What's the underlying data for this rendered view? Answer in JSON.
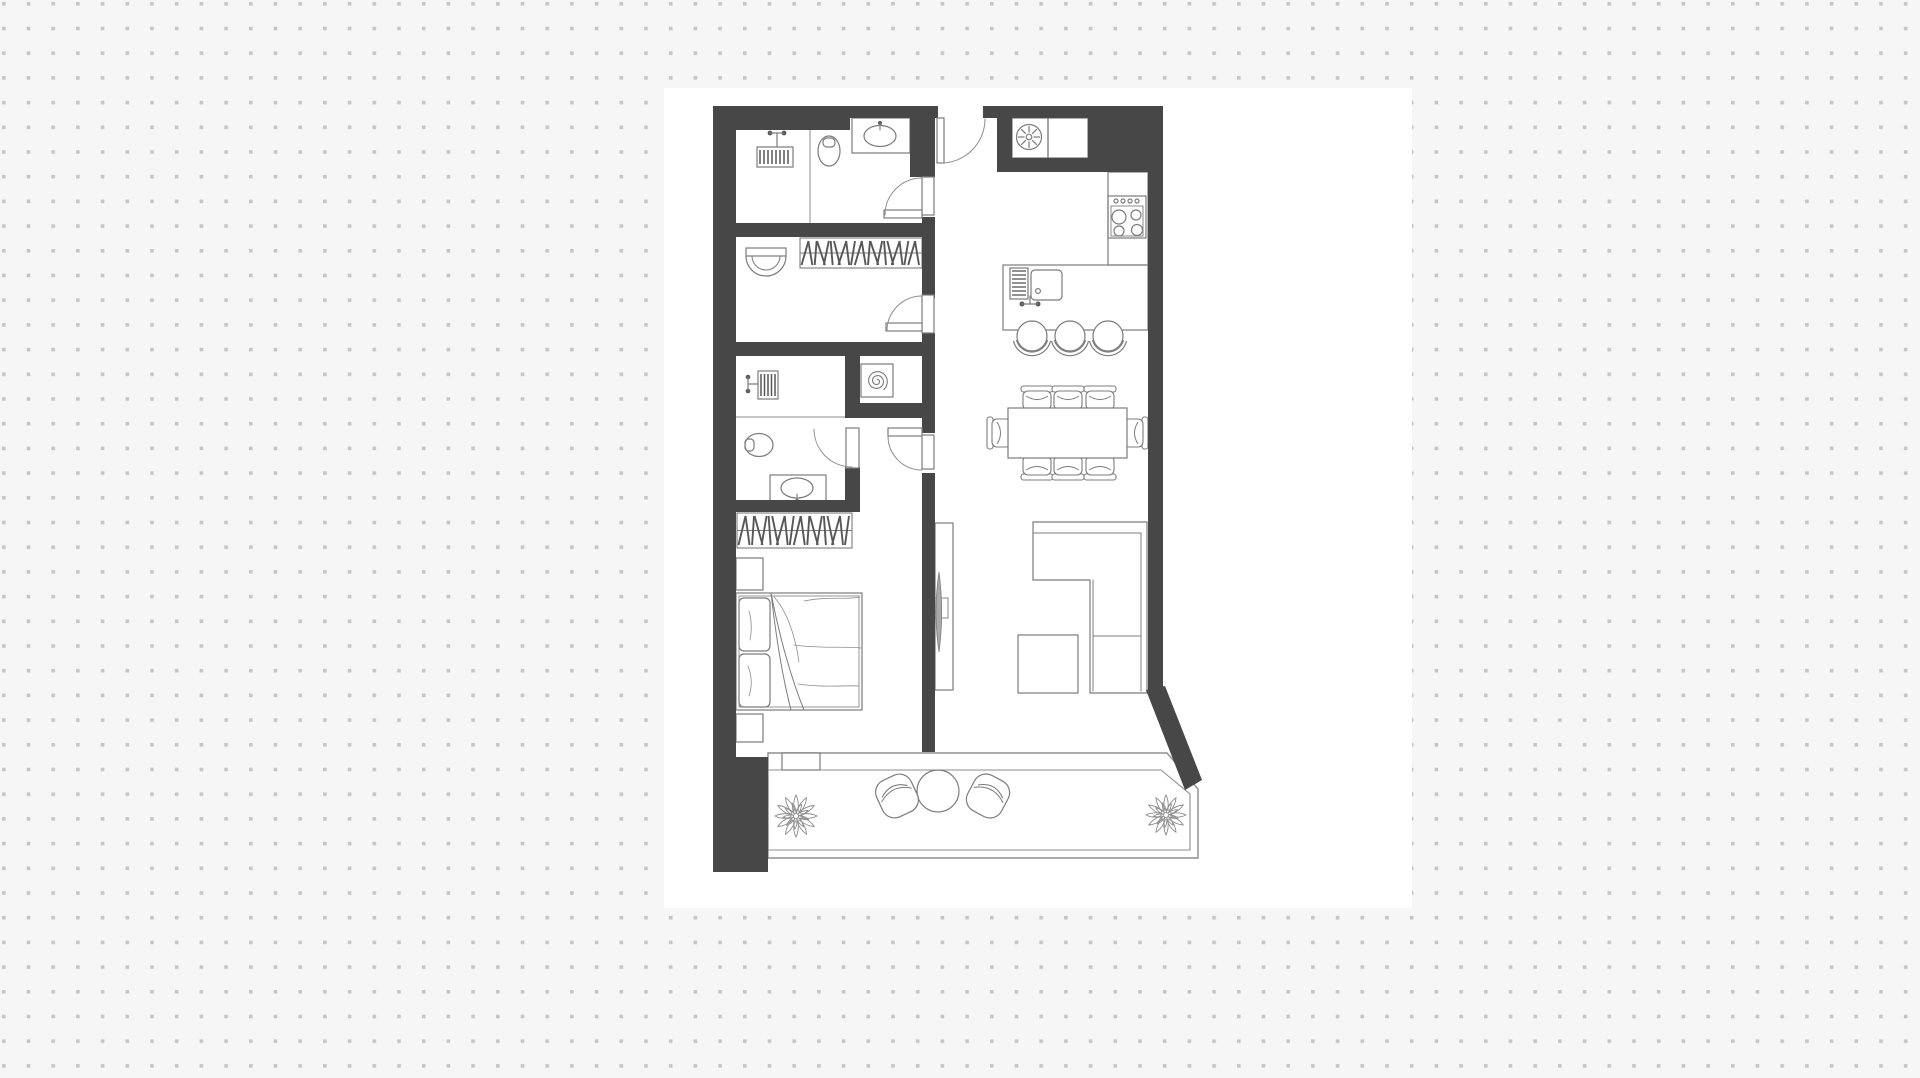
{
  "canvas": {
    "width": 1920,
    "height": 1078,
    "dot_spacing": 24.7,
    "dot_size": 3.6,
    "card": {
      "x": 664,
      "y": 88,
      "w": 748,
      "h": 820
    }
  },
  "palette": {
    "background": "#f6f6f6",
    "dot": "#c6c6c6",
    "card": "#ffffff",
    "wall": "#474747",
    "furniture_line": "#7c7c7c",
    "thin_line": "#8d8d8d",
    "hatch": "#575757",
    "tv_screen": "#a9a9a9"
  },
  "floor_plan": {
    "description": "apartment-floor-plan-top-view",
    "elements": [
      {
        "t": "sil",
        "n": "apartment-outline",
        "pts": [
          [
            713,
            106
          ],
          [
            1163,
            106
          ],
          [
            1163,
            688
          ],
          [
            1200,
            782
          ],
          [
            1200,
            858
          ],
          [
            713,
            858
          ]
        ]
      },
      {
        "t": "path",
        "n": "balcony-outer-border",
        "d": "M768,753 L1167,753 L1198,789 L1198,858 L768,858 Z",
        "s": "thin",
        "w": 1.4
      },
      {
        "t": "path",
        "n": "balcony-inner-border",
        "d": "M768,770 L1161,770 L1190,794 L1190,850 L768,850",
        "s": "thin",
        "w": 1.1
      },
      {
        "t": "line",
        "n": "bathroom1-divider",
        "l": [
          810,
          130,
          810,
          223
        ]
      },
      {
        "t": "orect",
        "n": "washing-machine",
        "r": [
          757,
          147,
          36,
          20
        ]
      },
      {
        "t": "hatchv",
        "n": "washing-machine-hatch",
        "r": [
          760,
          150,
          30,
          14
        ],
        "gap": 4
      },
      {
        "t": "dot",
        "n": "faucet-valve",
        "c": [
          770,
          133,
          2.4
        ]
      },
      {
        "t": "dot",
        "n": "faucet-valve",
        "c": [
          784,
          133,
          2.4
        ]
      },
      {
        "t": "path",
        "n": "washer-faucet",
        "d": "M770,133 L784,133 M777,133 L777,147",
        "w": 1.2
      },
      {
        "t": "ell",
        "n": "toilet-bowl",
        "e": [
          829,
          151,
          11,
          15
        ]
      },
      {
        "t": "orect",
        "n": "toilet-flush",
        "r": [
          823,
          138,
          12,
          9
        ],
        "rx": 4
      },
      {
        "t": "wrect",
        "n": "sink-counter",
        "r": [
          852,
          118,
          58,
          35
        ]
      },
      {
        "t": "ell",
        "n": "sink-basin",
        "e": [
          880,
          136,
          16,
          10.5
        ]
      },
      {
        "t": "dot",
        "n": "sink-faucet",
        "c": [
          880,
          123,
          2
        ]
      },
      {
        "t": "path",
        "n": "sink-faucet-stem",
        "d": "M880,123 L880,130",
        "w": 1.1
      },
      {
        "t": "rail",
        "n": "closet-hanger-rail",
        "r": [
          800,
          238,
          122,
          30
        ],
        "nl": 22
      },
      {
        "t": "wrect",
        "n": "wall-basin-top",
        "r": [
          746,
          248,
          40,
          8
        ]
      },
      {
        "t": "path",
        "n": "wall-basin",
        "d": "M746,256 A20,20 0 0 0 786,256",
        "w": 1.2
      },
      {
        "t": "path",
        "n": "wall-basin-inner",
        "d": "M752,256 A14,14 0 0 0 780,256",
        "w": 1
      },
      {
        "t": "orect",
        "n": "boiler-box",
        "r": [
          861,
          364,
          32,
          33
        ]
      },
      {
        "t": "spiral",
        "n": "boiler-spiral",
        "c": [
          877,
          381
        ],
        "r0": 1.5,
        "r1": 11,
        "turns": 2.4
      },
      {
        "t": "orect",
        "n": "washing-machine-2",
        "r": [
          758,
          371,
          20,
          28
        ]
      },
      {
        "t": "hatchv",
        "n": "washing-machine-2-hatch",
        "r": [
          761,
          374,
          14,
          22
        ],
        "gap": 3.5
      },
      {
        "t": "dot",
        "n": "faucet-valve",
        "c": [
          748,
          377,
          2.3
        ]
      },
      {
        "t": "dot",
        "n": "faucet-valve",
        "c": [
          748,
          391,
          2.3
        ]
      },
      {
        "t": "path",
        "n": "washer2-faucet",
        "d": "M748,377 L748,391 M748,384 L758,384",
        "w": 1.2
      },
      {
        "t": "line",
        "n": "bathroom2-divider",
        "l": [
          736,
          417,
          845,
          417
        ]
      },
      {
        "t": "ell",
        "n": "toilet2-bowl",
        "e": [
          759,
          445,
          14,
          11.5
        ]
      },
      {
        "t": "orect",
        "n": "toilet2-flush",
        "r": [
          745,
          439,
          9,
          12
        ],
        "rx": 3.5
      },
      {
        "t": "wrect",
        "n": "sink2-counter",
        "r": [
          770,
          475,
          56,
          28
        ]
      },
      {
        "t": "ell",
        "n": "sink2-basin",
        "e": [
          797,
          488,
          16,
          10
        ]
      },
      {
        "t": "dot",
        "n": "sink2-faucet",
        "c": [
          797,
          501,
          2
        ]
      },
      {
        "t": "path",
        "n": "sink2-faucet-stem",
        "d": "M797,501 L797,494",
        "w": 1.1
      },
      {
        "t": "rail",
        "n": "wardrobe-hanger-rail",
        "r": [
          737,
          513,
          115,
          35
        ],
        "nl": 20
      },
      {
        "t": "orect",
        "n": "nightstand",
        "r": [
          736,
          558,
          27,
          32
        ]
      },
      {
        "t": "orect",
        "n": "nightstand",
        "r": [
          736,
          714,
          27,
          28
        ]
      },
      {
        "t": "orect",
        "n": "bed-frame",
        "r": [
          736,
          593,
          126,
          117
        ]
      },
      {
        "t": "orect",
        "n": "bed-mattress",
        "r": [
          739,
          596,
          120,
          111
        ],
        "w": 0.8
      },
      {
        "t": "wrect",
        "n": "pillow",
        "r": [
          739,
          598,
          31,
          53
        ],
        "rx": 5
      },
      {
        "t": "wrect",
        "n": "pillow",
        "r": [
          739,
          654,
          31,
          53
        ],
        "rx": 5
      },
      {
        "t": "path",
        "n": "pillow-crease",
        "d": "M749,611 Q753,625 750,640 M748,666 Q754,681 749,696",
        "w": 0.8,
        "s": "thin"
      },
      {
        "t": "path",
        "n": "blanket-fold",
        "d": "M771,593 C779,635 791,678 804,710 M771,593 C776,637 783,679 791,710",
        "w": 1
      },
      {
        "t": "path",
        "n": "blanket-sketch",
        "d": "M804,601 C828,596 848,600 860,597 M794,645 C822,649 846,646 861,648 M798,684 C824,688 847,685 859,686 M774,597 C788,612 796,640 799,662",
        "w": 0.8,
        "s": "thin"
      },
      {
        "t": "orect",
        "n": "entry-cabinet",
        "r": [
          1012,
          118,
          36,
          40
        ]
      },
      {
        "t": "orect",
        "n": "entry-cabinet",
        "r": [
          1048,
          118,
          40,
          40
        ]
      },
      {
        "t": "circ",
        "n": "extractor-fan",
        "c": [
          1029,
          137,
          12.5
        ]
      },
      {
        "t": "circ",
        "n": "extractor-fan-hub",
        "c": [
          1029,
          137,
          2.8
        ]
      },
      {
        "t": "spokes",
        "n": "extractor-fan-spokes",
        "c": [
          1029,
          137
        ],
        "r0": 4.5,
        "r1": 11,
        "nl": 8
      },
      {
        "t": "orect",
        "n": "kitchen-counter",
        "r": [
          1108,
          172,
          40,
          93
        ]
      },
      {
        "t": "orect",
        "n": "stove",
        "r": [
          1108,
          196,
          38,
          42
        ]
      },
      {
        "t": "orect",
        "n": "stove-panel",
        "r": [
          1111,
          206,
          32,
          30
        ],
        "w": 0.9
      },
      {
        "t": "circ",
        "n": "stove-knob",
        "c": [
          1116,
          201,
          2
        ]
      },
      {
        "t": "circ",
        "n": "stove-knob",
        "c": [
          1123,
          201,
          2
        ]
      },
      {
        "t": "circ",
        "n": "stove-knob",
        "c": [
          1130,
          201,
          2
        ]
      },
      {
        "t": "circ",
        "n": "stove-knob",
        "c": [
          1137,
          201,
          2
        ]
      },
      {
        "t": "circ",
        "n": "burner",
        "c": [
          1119,
          217,
          7
        ]
      },
      {
        "t": "circ",
        "n": "burner",
        "c": [
          1136,
          215,
          5
        ]
      },
      {
        "t": "circ",
        "n": "burner",
        "c": [
          1119,
          231,
          5
        ]
      },
      {
        "t": "circ",
        "n": "burner",
        "c": [
          1137,
          230,
          5.5
        ]
      },
      {
        "t": "orect",
        "n": "kitchen-island",
        "r": [
          1003,
          265,
          145,
          65
        ]
      },
      {
        "t": "orect",
        "n": "dish-rack",
        "r": [
          1010,
          268,
          18,
          31
        ]
      },
      {
        "t": "hatchh",
        "n": "dish-rack-bars",
        "r": [
          1012,
          271,
          14,
          26
        ],
        "gap": 4
      },
      {
        "t": "orect",
        "n": "island-sink",
        "r": [
          1031,
          270,
          31,
          30
        ],
        "rx": 4
      },
      {
        "t": "circ",
        "n": "sink-drain",
        "c": [
          1038,
          291,
          2.4
        ]
      },
      {
        "t": "dot",
        "n": "island-faucet-valve",
        "c": [
          1022,
          304,
          2.5
        ]
      },
      {
        "t": "dot",
        "n": "island-faucet-valve",
        "c": [
          1038,
          304,
          2.5
        ]
      },
      {
        "t": "path",
        "n": "island-faucet",
        "d": "M1022,304 L1038,304 M1030,304 L1030,296",
        "w": 1.2
      },
      {
        "t": "stool",
        "n": "bar-stool",
        "c": [
          1032,
          336
        ]
      },
      {
        "t": "stool",
        "n": "bar-stool",
        "c": [
          1070,
          336
        ]
      },
      {
        "t": "stool",
        "n": "bar-stool",
        "c": [
          1108,
          336
        ]
      },
      {
        "t": "chair",
        "n": "dining-chair",
        "c": [
          1037,
          398
        ],
        "rot": 0
      },
      {
        "t": "chair",
        "n": "dining-chair",
        "c": [
          1068,
          398
        ],
        "rot": 0
      },
      {
        "t": "chair",
        "n": "dining-chair",
        "c": [
          1100,
          398
        ],
        "rot": 0
      },
      {
        "t": "chair",
        "n": "dining-chair",
        "c": [
          1037,
          468
        ],
        "rot": 180
      },
      {
        "t": "chair",
        "n": "dining-chair",
        "c": [
          1068,
          468
        ],
        "rot": 180
      },
      {
        "t": "chair",
        "n": "dining-chair",
        "c": [
          1100,
          468
        ],
        "rot": 180
      },
      {
        "t": "chair",
        "n": "dining-chair",
        "c": [
          999,
          433
        ],
        "rot": 270
      },
      {
        "t": "chair",
        "n": "dining-chair",
        "c": [
          1136,
          433
        ],
        "rot": 90
      },
      {
        "t": "wrect",
        "n": "dining-table",
        "r": [
          1008,
          408,
          119,
          50
        ]
      },
      {
        "t": "path",
        "n": "sofa-outline",
        "d": "M1033,522 L1147,522 L1147,693 L1090,693 L1090,580 L1033,580 Z",
        "w": 1.2
      },
      {
        "t": "path",
        "n": "sofa-lines",
        "d": "M1033,533 L1141,533 M1141,533 L1141,691 M1093,580 L1093,691 M1093,636 L1141,636",
        "w": 1
      },
      {
        "t": "orect",
        "n": "coffee-table",
        "r": [
          1018,
          635,
          60,
          58
        ]
      },
      {
        "t": "orect",
        "n": "tv-panel",
        "r": [
          935,
          523,
          18,
          167
        ]
      },
      {
        "t": "orect",
        "n": "tv-mount",
        "r": [
          933,
          598,
          15,
          20
        ],
        "w": 0.9
      },
      {
        "t": "path",
        "n": "tv-screen",
        "d": "M939,572 C935,599 935,626 939,652 C942.5,626 942.5,599 939,572 Z",
        "f": "tv",
        "w": 0.8
      },
      {
        "t": "wrect",
        "n": "balcony-door",
        "r": [
          782,
          753,
          38,
          17
        ]
      },
      {
        "t": "circ",
        "n": "balcony-table",
        "c": [
          938,
          791,
          21
        ]
      },
      {
        "t": "bchair",
        "n": "balcony-chair",
        "c": [
          897,
          796
        ],
        "rot": -25
      },
      {
        "t": "bchair",
        "n": "balcony-chair",
        "c": [
          988,
          796
        ],
        "rot": 28
      },
      {
        "t": "plant",
        "n": "potted-plant",
        "c": [
          796,
          816
        ],
        "r": 21
      },
      {
        "t": "plant",
        "n": "potted-plant",
        "c": [
          1166,
          815
        ],
        "r": 20
      },
      {
        "t": "wallr",
        "n": "wall",
        "r": [
          713,
          106,
          137,
          24
        ]
      },
      {
        "t": "wallr",
        "n": "wall",
        "r": [
          850,
          106,
          88,
          12
        ]
      },
      {
        "t": "wallr",
        "n": "wall",
        "r": [
          983,
          106,
          29,
          12
        ]
      },
      {
        "t": "wallr",
        "n": "wall",
        "r": [
          997,
          118,
          15,
          54
        ]
      },
      {
        "t": "wallr",
        "n": "wall",
        "r": [
          1012,
          106,
          76,
          12
        ]
      },
      {
        "t": "wallr",
        "n": "wall",
        "r": [
          1012,
          158,
          76,
          14
        ]
      },
      {
        "t": "wallr",
        "n": "wall",
        "r": [
          1088,
          106,
          75,
          66
        ]
      },
      {
        "t": "wallr",
        "n": "wall",
        "r": [
          1148,
          172,
          15,
          520
        ]
      },
      {
        "t": "wallr",
        "n": "wall",
        "r": [
          713,
          106,
          23,
          651
        ]
      },
      {
        "t": "wallr",
        "n": "wall",
        "r": [
          713,
          757,
          55,
          115
        ]
      },
      {
        "t": "wallr",
        "n": "wall",
        "r": [
          713,
          223,
          222,
          14
        ]
      },
      {
        "t": "wallr",
        "n": "wall",
        "r": [
          713,
          342,
          222,
          14
        ]
      },
      {
        "t": "wallr",
        "n": "wall",
        "r": [
          845,
          356,
          15,
          62
        ]
      },
      {
        "t": "wallr",
        "n": "wall",
        "r": [
          860,
          403,
          75,
          15
        ]
      },
      {
        "t": "wallr",
        "n": "wall",
        "r": [
          845,
          467,
          15,
          45
        ]
      },
      {
        "t": "wallr",
        "n": "wall",
        "r": [
          713,
          500,
          132,
          12
        ]
      },
      {
        "t": "wallr",
        "n": "wall",
        "r": [
          910,
          118,
          25,
          59
        ]
      },
      {
        "t": "wallr",
        "n": "wall",
        "r": [
          922,
          217,
          13,
          81
        ]
      },
      {
        "t": "wallr",
        "n": "wall",
        "r": [
          922,
          333,
          13,
          100
        ]
      },
      {
        "t": "wallr",
        "n": "wall",
        "r": [
          922,
          473,
          13,
          279
        ]
      },
      {
        "t": "wallp",
        "n": "wall-diagonal",
        "pts": [
          [
            1146,
            690
          ],
          [
            1165,
            686
          ],
          [
            1202,
            780
          ],
          [
            1185,
            790
          ]
        ]
      },
      {
        "t": "wrect",
        "n": "door-jamb",
        "r": [
          937,
          118,
          7,
          45
        ]
      },
      {
        "t": "path",
        "n": "door-swing",
        "d": "M941,163 A44,44 0 0 0 985,119",
        "s": "thin",
        "w": 1
      },
      {
        "t": "wrect",
        "n": "door-jamb",
        "r": [
          922,
          177,
          12,
          38
        ]
      },
      {
        "t": "wrect",
        "n": "door-leaf",
        "r": [
          884,
          210,
          38,
          8
        ]
      },
      {
        "t": "path",
        "n": "door-swing",
        "d": "M922,178 A37,37 0 0 0 885,215",
        "s": "thin",
        "w": 1
      },
      {
        "t": "wrect",
        "n": "door-jamb",
        "r": [
          922,
          295,
          12,
          38
        ]
      },
      {
        "t": "wrect",
        "n": "door-leaf",
        "r": [
          886,
          323,
          36,
          8
        ]
      },
      {
        "t": "path",
        "n": "door-swing",
        "d": "M922,296 A35,35 0 0 0 887,331",
        "s": "thin",
        "w": 1
      },
      {
        "t": "wrect",
        "n": "door-jamb",
        "r": [
          922,
          435,
          12,
          34
        ]
      },
      {
        "t": "wrect",
        "n": "door-leaf",
        "r": [
          888,
          428,
          34,
          8
        ]
      },
      {
        "t": "path",
        "n": "door-swing",
        "d": "M888,436 A34,34 0 0 0 922,470",
        "s": "thin",
        "w": 1
      },
      {
        "t": "wrect",
        "n": "door-leaf",
        "r": [
          846,
          428,
          13,
          40
        ]
      },
      {
        "t": "path",
        "n": "door-swing",
        "d": "M814,429 A38,38 0 0 0 852,467",
        "s": "thin",
        "w": 1
      }
    ]
  }
}
